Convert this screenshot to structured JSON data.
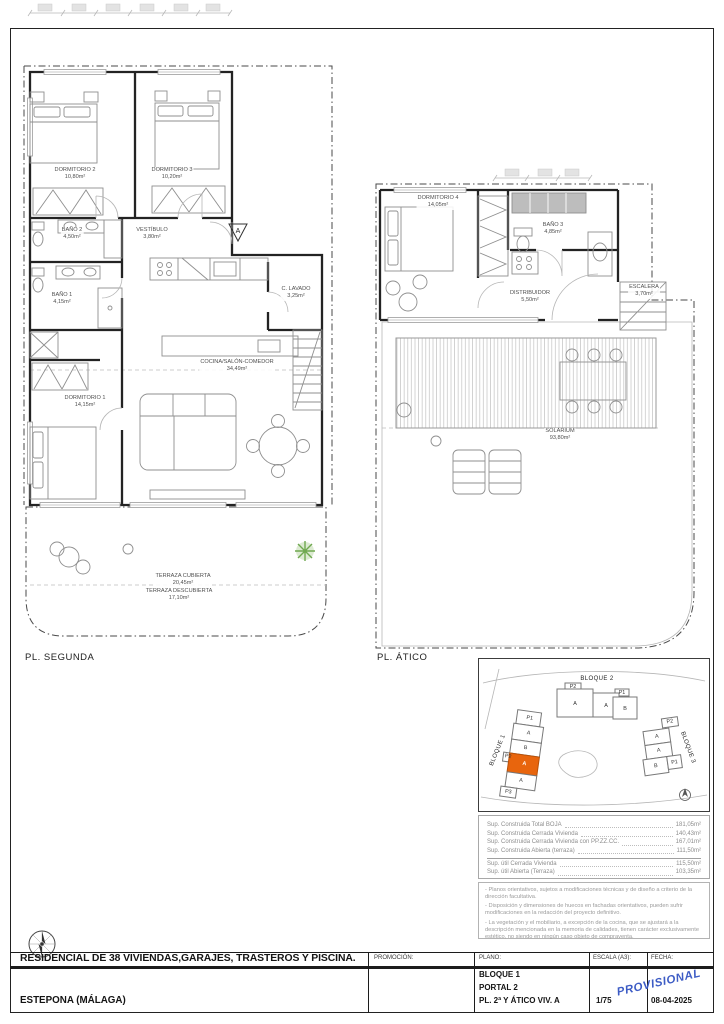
{
  "sheet": {
    "captions": {
      "segunda": "PL. SEGUNDA",
      "atico": "PL. ÁTICO"
    }
  },
  "plans": {
    "segunda": {
      "section_marker": "A",
      "rooms": {
        "dorm2": {
          "name": "DORMITORIO 2",
          "area": "10,80m²"
        },
        "dorm3": {
          "name": "DORMITORIO 3",
          "area": "10,20m²"
        },
        "bano2": {
          "name": "BAÑO 2",
          "area": "4,50m²"
        },
        "vestibulo": {
          "name": "VESTÍBULO",
          "area": "3,80m²"
        },
        "bano1": {
          "name": "BAÑO 1",
          "area": "4,15m²"
        },
        "lavado": {
          "name": "C. LAVADO",
          "area": "3,25m²"
        },
        "cocina": {
          "name": "COCINA/SALÓN-COMEDOR",
          "area": "34,49m²"
        },
        "dorm1": {
          "name": "DORMITORIO 1",
          "area": "14,15m²"
        },
        "terraza_cubierta": {
          "name": "TERRAZA CUBIERTA",
          "area": "20,45m²"
        },
        "terraza_descubierta": {
          "name": "TERRAZA DESCUBIERTA",
          "area": "17,10m²"
        }
      }
    },
    "atico": {
      "rooms": {
        "dorm4": {
          "name": "DORMITORIO 4",
          "area": "14,05m²"
        },
        "bano3": {
          "name": "BAÑO 3",
          "area": "4,85m²"
        },
        "distribuidor": {
          "name": "DISTRIBUIDOR",
          "area": "5,50m²"
        },
        "escalera": {
          "name": "ESCALERA",
          "area": "3,70m²"
        },
        "solarium": {
          "name": "SOLARIUM",
          "area": "93,80m²"
        }
      }
    }
  },
  "site_plan": {
    "bloque1": "BLOQUE 1",
    "bloque2": "BLOQUE 2",
    "bloque3": "BLOQUE 3",
    "unit_a": "A",
    "unit_b": "B",
    "p1": "P1",
    "p2": "P2",
    "p3": "P3",
    "highlight_color": "#e8650d"
  },
  "area_table": {
    "rows": [
      {
        "label": "Sup. Construida Total BOJA",
        "value": "181,05m²"
      },
      {
        "label": "Sup. Construida Cerrada Vivienda",
        "value": "140,43m²"
      },
      {
        "label": "Sup. Construida Cerrada Vivienda con PP.ZZ.CC.",
        "value": "167,01m²"
      },
      {
        "label": "Sup. Construida Abierta (terraza)",
        "value": "111,50m²"
      }
    ],
    "util_rows": [
      {
        "label": "Sup. útil Cerrada Vivienda",
        "value": "115,50m²"
      },
      {
        "label": "Sup. útil Abierta (Terraza)",
        "value": "103,35m²"
      }
    ]
  },
  "notes": [
    "- Planos orientativos, sujetos a modificaciones técnicas y de diseño a criterio de la dirección facultativa.",
    "- Disposición y dimensiones de huecos en fachadas orientativos, pueden sufrir modificaciones en la redacción del proyecto definitivo.",
    "- La vegetación y el mobiliario, a excepción de la cocina, que se ajustará a la descripción mencionada en la memoria de calidades, tienen carácter exclusivamente estético, no siendo en ningún caso objeto de compraventa."
  ],
  "title_block": {
    "project_title": "RESIDENCIAL DE 38 VIVIENDAS,GARAJES, TRASTEROS Y PISCINA.",
    "promocion_label": "PROMOCIÓN:",
    "plano_label": "PLANO:",
    "escala_label": "ESCALA (A3):",
    "fecha_label": "FECHA:",
    "location": "ESTEPONA (MÁLAGA)",
    "plano_lines": [
      "BLOQUE 1",
      "PORTAL 2",
      "PL. 2ª Y ÁTICO VIV. A"
    ],
    "escala_value": "1/75",
    "fecha_value": "08-04-2025",
    "stamp": "PROVISIONAL",
    "stamp_color": "#3d5cc5"
  }
}
